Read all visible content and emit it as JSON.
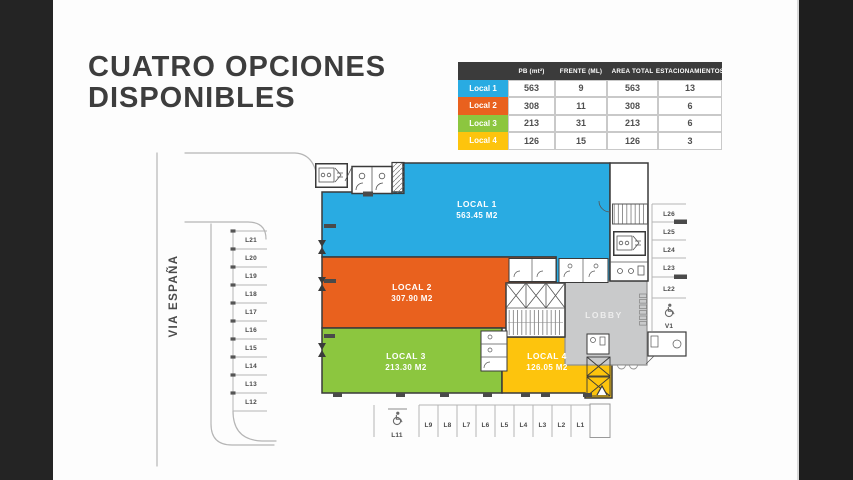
{
  "slide": {
    "title_line1": "CUATRO OPCIONES",
    "title_line2": "DISPONIBLES"
  },
  "table": {
    "headers": [
      "",
      "PB (mt²)",
      "FRENTE (ML)",
      "AREA TOTAL",
      "ESTACIONAMIENTOS"
    ],
    "rows": [
      {
        "label": "Local 1",
        "color": "#29ABE2",
        "values": [
          "563",
          "9",
          "563",
          "13"
        ]
      },
      {
        "label": "Local 2",
        "color": "#E9611E",
        "values": [
          "308",
          "11",
          "308",
          "6"
        ]
      },
      {
        "label": "Local 3",
        "color": "#8CC63F",
        "values": [
          "213",
          "31",
          "213",
          "6"
        ]
      },
      {
        "label": "Local 4",
        "color": "#FDC40D",
        "values": [
          "126",
          "15",
          "126",
          "3"
        ]
      }
    ]
  },
  "plan": {
    "street_label": "VIA ESPAÑA",
    "lobby_label": "LOBBY",
    "locals": [
      {
        "name": "LOCAL 1",
        "area": "563.45 M2",
        "color": "#29ABE2"
      },
      {
        "name": "LOCAL 2",
        "area": "307.90 M2",
        "color": "#E9611E"
      },
      {
        "name": "LOCAL 3",
        "area": "213.30 M2",
        "color": "#8CC63F"
      },
      {
        "name": "LOCAL 4",
        "area": "126.05 M2",
        "color": "#FDC40D"
      }
    ],
    "lobby_color": "#C9CACB",
    "parking_left": [
      "L21",
      "L20",
      "L19",
      "L18",
      "L17",
      "L16",
      "L15",
      "L14",
      "L13",
      "L12"
    ],
    "parking_bottom": [
      "L9",
      "L8",
      "L7",
      "L6",
      "L5",
      "L4",
      "L3",
      "L2",
      "L1"
    ],
    "parking_bottom_accessible": "L11",
    "parking_right": [
      "L26",
      "L25",
      "L24",
      "L23",
      "L22"
    ],
    "parking_right_accessible": "V1"
  }
}
